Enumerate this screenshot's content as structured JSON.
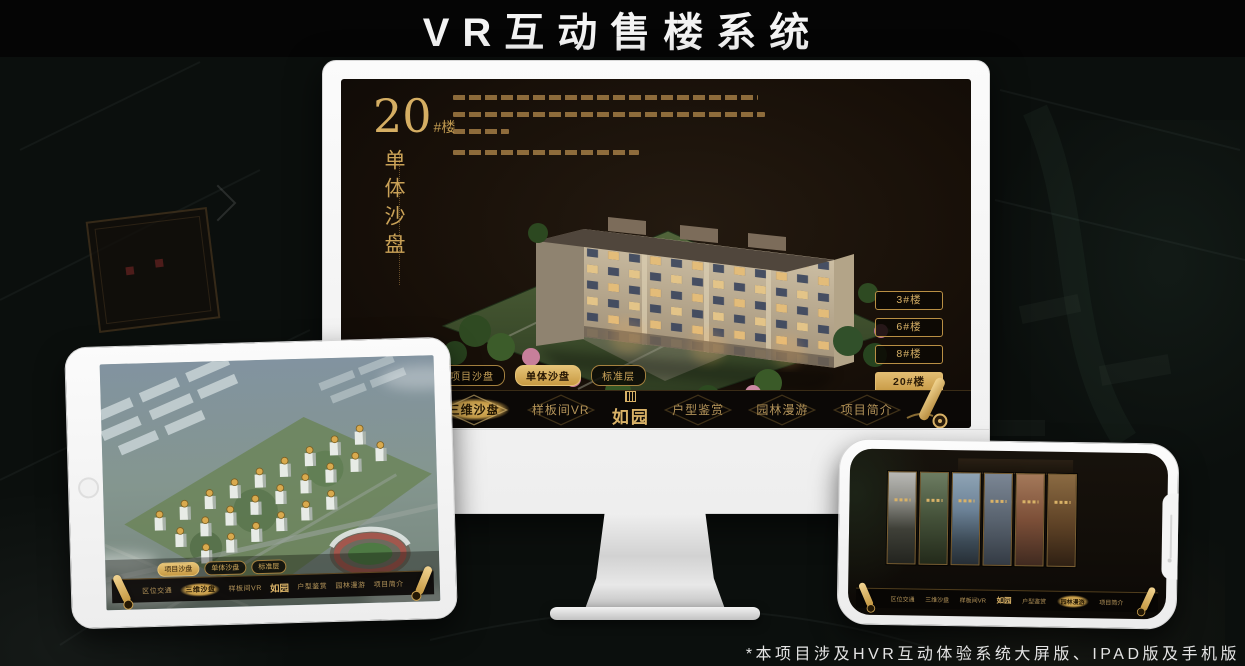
{
  "page": {
    "title": "VR互动售楼系统",
    "footnote": "*本项目涉及HVR互动体验系统大屏版、IPAD版及手机版"
  },
  "colors": {
    "gold_accent": "#c9a357",
    "gold_active_bg": "#d9b162",
    "screen_background": "#1a130d",
    "device_frame": "#f4f4f4",
    "page_background": "#0b0f0d"
  },
  "app": {
    "brand": "如园",
    "nav_items": [
      {
        "label": "区位交通"
      },
      {
        "label": "三维沙盘"
      },
      {
        "label": "样板间VR"
      },
      {
        "label": "户型鉴赏"
      },
      {
        "label": "园林漫游"
      },
      {
        "label": "项目简介"
      }
    ],
    "sub_tabs": [
      {
        "label": "项目沙盘"
      },
      {
        "label": "单体沙盘"
      },
      {
        "label": "标准层"
      }
    ]
  },
  "monitor": {
    "heading_number": "20",
    "heading_suffix": "#楼",
    "heading_vertical": "单体沙盘",
    "building_buttons": [
      {
        "label": "3#楼"
      },
      {
        "label": "6#楼"
      },
      {
        "label": "8#楼"
      },
      {
        "label": "20#楼"
      }
    ]
  }
}
